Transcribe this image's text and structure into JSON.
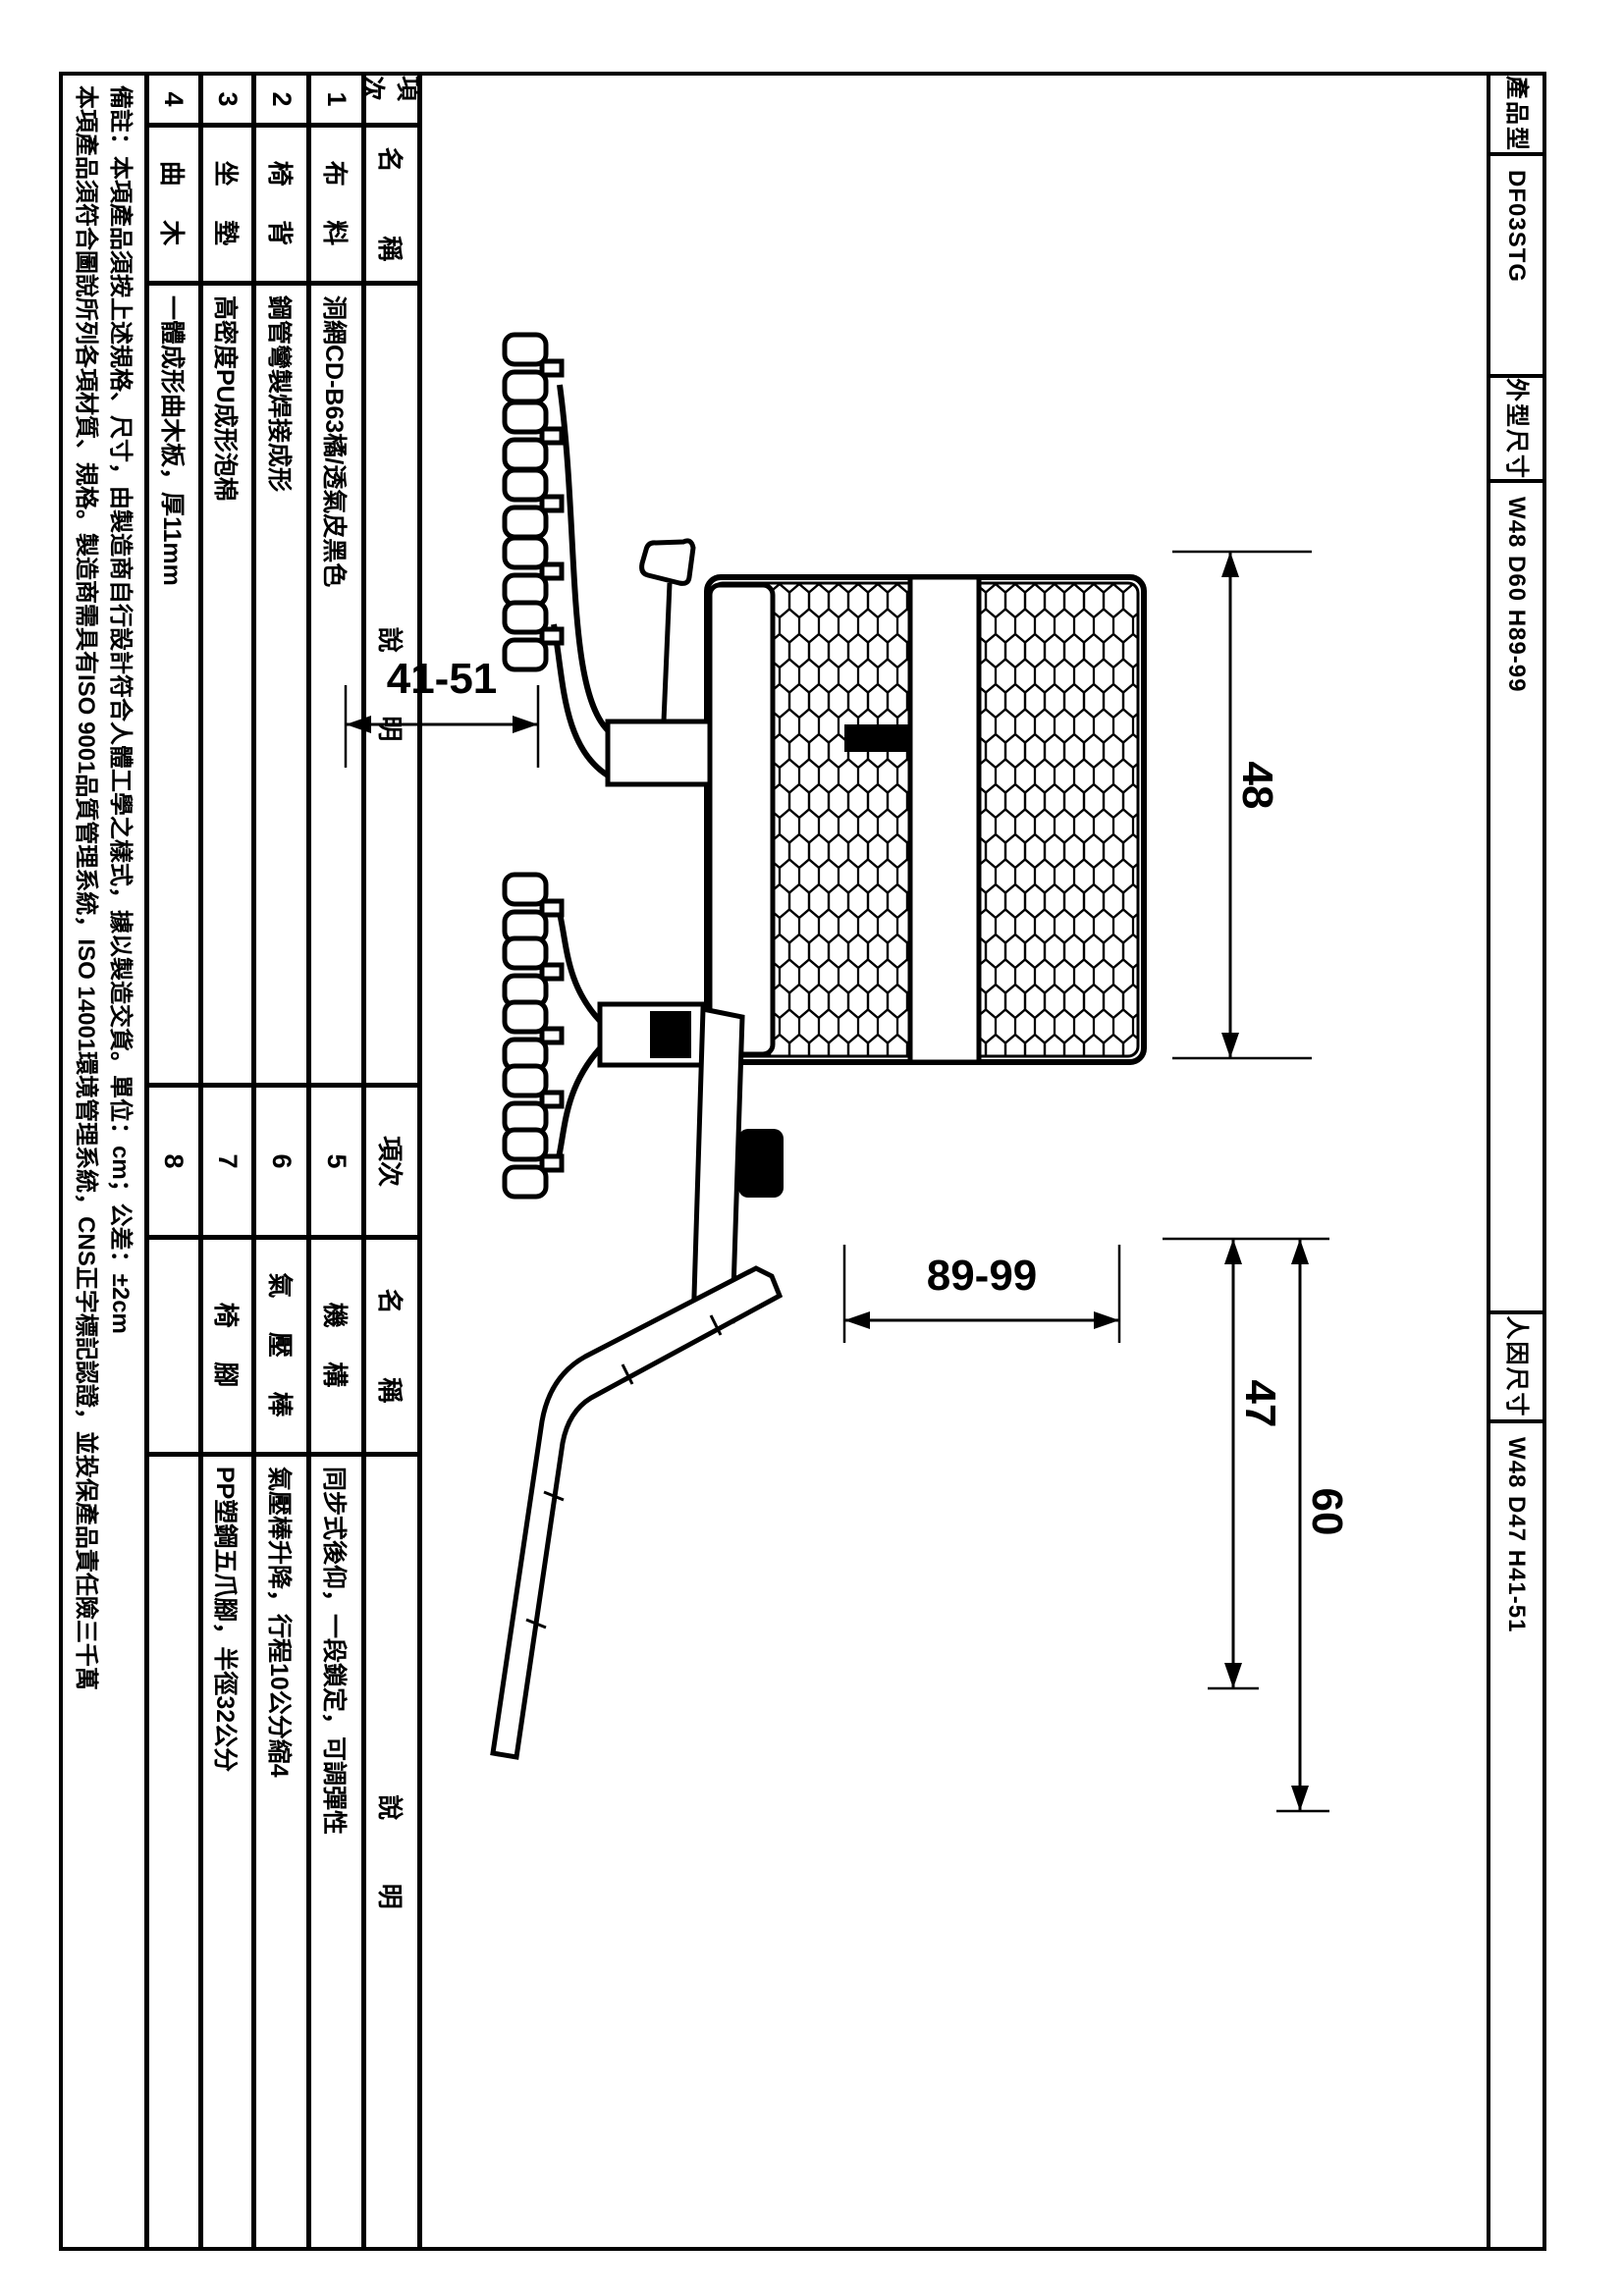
{
  "header": {
    "product_model_label": "產品型號",
    "product_model_value": "DF03STG",
    "outer_dims_label": "外型尺寸",
    "outer_dims_value": "W48 D60 H89-99",
    "ergo_dims_label": "人因尺寸",
    "ergo_dims_value": "W48 D47 H41-51"
  },
  "table": {
    "item_header": "項次",
    "name_header": "名 稱",
    "desc_header": "說 明",
    "rows": [
      {
        "no": "1",
        "name": "布 料",
        "desc": "洞網CD-B63橘/透氣皮黑色"
      },
      {
        "no": "2",
        "name": "椅 背",
        "desc": "鋼管彎製焊接成形"
      },
      {
        "no": "3",
        "name": "坐 墊",
        "desc": "高密度PU成形泡棉"
      },
      {
        "no": "4",
        "name": "曲 木",
        "desc": "一體成形曲木板，厚11mm"
      },
      {
        "no": "5",
        "name": "機 構",
        "desc": "同步式後仰，一段鎖定，可調彈性"
      },
      {
        "no": "6",
        "name": "氣 壓 棒",
        "desc": "氣壓棒升降，行程10公分縮4"
      },
      {
        "no": "7",
        "name": "椅 腳",
        "desc": "PP塑鋼五爪腳，半徑32公分"
      },
      {
        "no": "8",
        "name": "",
        "desc": ""
      }
    ]
  },
  "notes": {
    "line1": "備註：本項產品須按上述規格、尺寸，由製造商自行設計符合人體工學之樣式，據以製造交貨。單位：cm；公差：±2cm",
    "line2": "本項產品須符合圖說所列各項材質、規格。製造商需具有ISO 9001品質管理系統，ISO 14001環境管理系統，CNS正字標記認證，並投保產品責任險三千萬"
  },
  "drawings": {
    "front_view": {
      "back_width": "48",
      "seat_height_range": "41-51"
    },
    "side_view": {
      "depth": "60",
      "seat_depth": "47",
      "height_range": "89-99"
    }
  }
}
